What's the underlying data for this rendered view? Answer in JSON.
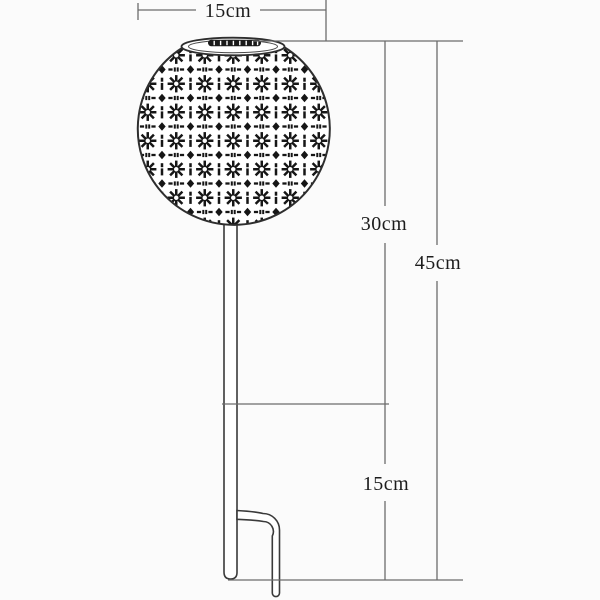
{
  "diagram": {
    "name": "solar-stake-light-dimension-diagram",
    "subject": "patterned globe solar garden stake light with dimension annotations",
    "labels": {
      "globe_width": "15cm",
      "upper_height": "30cm",
      "total_height": "45cm",
      "stake_depth": "15cm"
    },
    "colors": {
      "background": "#fbfbfb",
      "dimension_line": "#6b6b6b",
      "figure_outline": "#3a3a3a",
      "pattern_ink": "#161616",
      "label_text": "#1c1c1c"
    }
  }
}
